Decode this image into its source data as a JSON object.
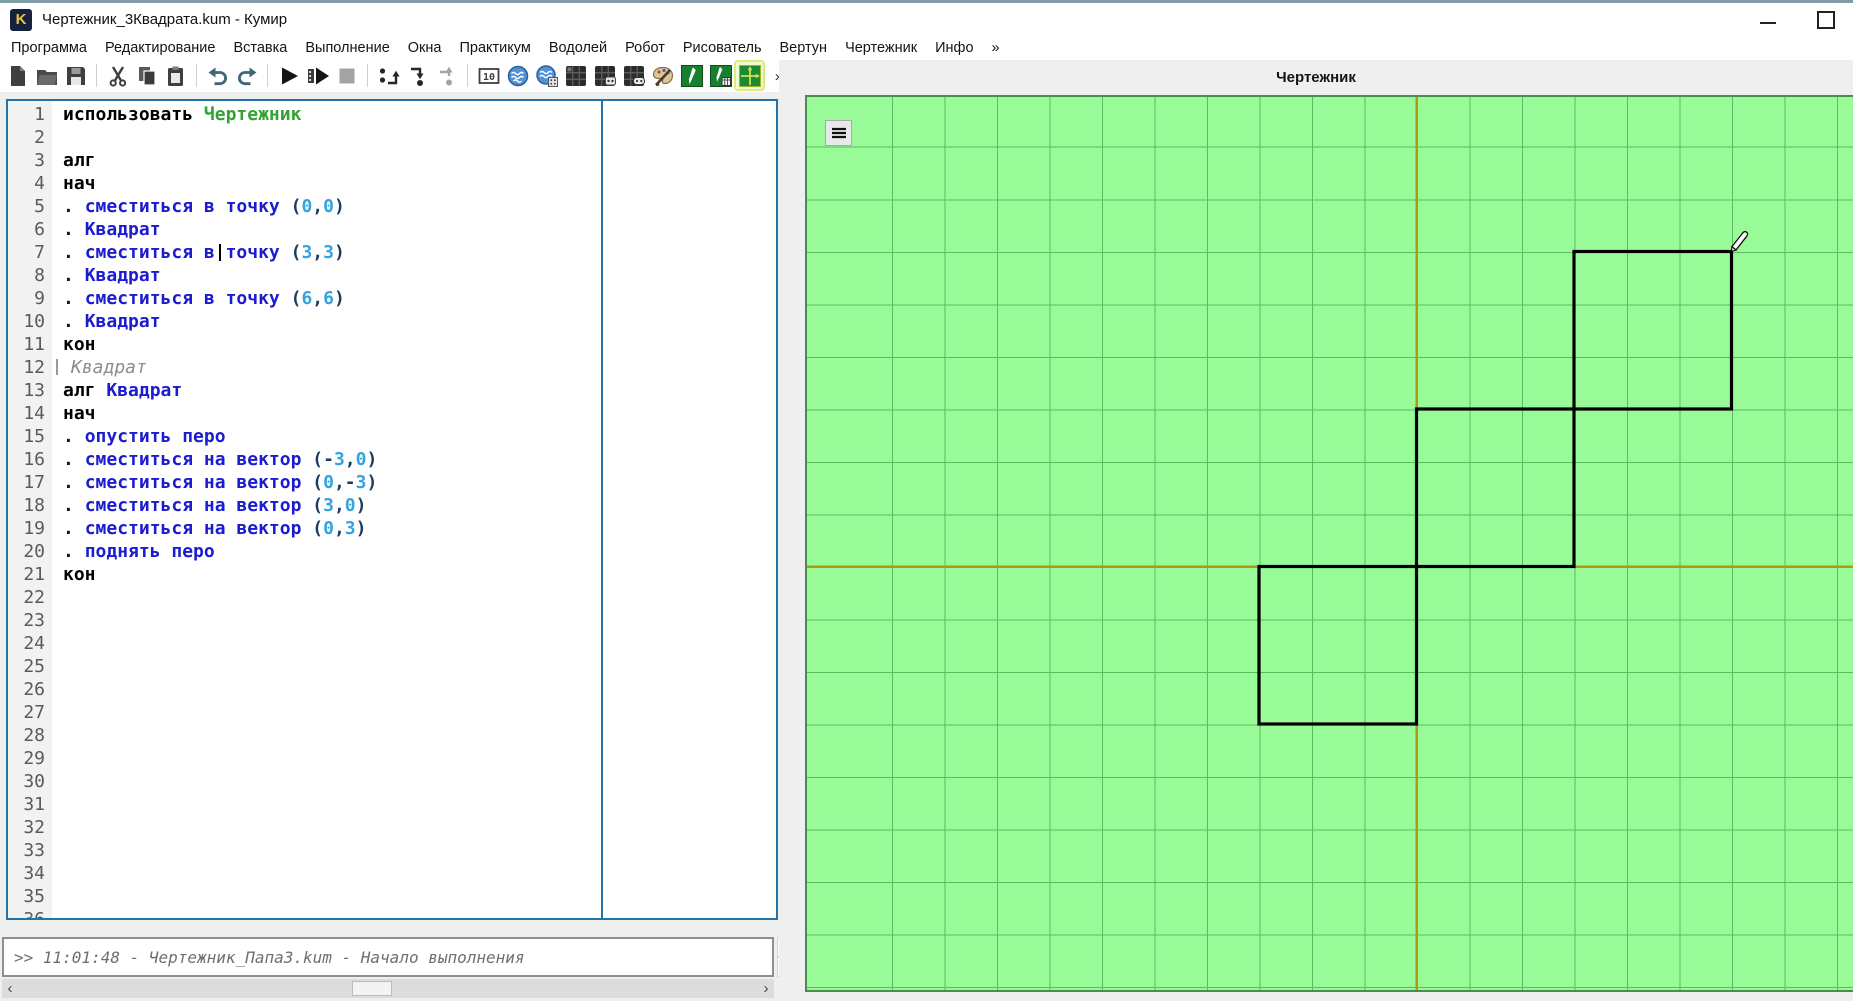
{
  "window": {
    "title": "Чертежник_3Квадрата.kum - Кумир",
    "logo_letter": "K",
    "controls": {
      "minimize": "minimize",
      "maximize": "maximize"
    }
  },
  "menu": {
    "items": [
      "Программа",
      "Редактирование",
      "Вставка",
      "Выполнение",
      "Окна",
      "Практикум",
      "Водолей",
      "Робот",
      "Рисователь",
      "Вертун",
      "Чертежник",
      "Инфо",
      "»"
    ]
  },
  "toolbar": {
    "items": [
      {
        "icon": "new-file"
      },
      {
        "icon": "open-file"
      },
      {
        "icon": "save-file",
        "sep_after": true
      },
      {
        "icon": "cut"
      },
      {
        "icon": "copy"
      },
      {
        "icon": "paste",
        "sep_after": true
      },
      {
        "icon": "undo"
      },
      {
        "icon": "redo",
        "sep_after": true
      },
      {
        "icon": "run"
      },
      {
        "icon": "run-detailed"
      },
      {
        "icon": "stop",
        "disabled": true,
        "sep_after": true
      },
      {
        "icon": "step-over"
      },
      {
        "icon": "step-into"
      },
      {
        "icon": "step-out",
        "disabled": true,
        "sep_after": true
      },
      {
        "icon": "io-window"
      },
      {
        "icon": "vodoley"
      },
      {
        "icon": "vodoley-pult"
      },
      {
        "icon": "robot"
      },
      {
        "icon": "robot-pult"
      },
      {
        "icon": "vertun"
      },
      {
        "icon": "risovatel"
      },
      {
        "icon": "chertezhnik"
      },
      {
        "icon": "chertezhnik-pult"
      },
      {
        "icon": "chertezhnik-window",
        "active": true
      },
      {
        "icon": "overflow-chevron"
      }
    ],
    "io_icon_text": "10",
    "overflow_label": "»"
  },
  "editor": {
    "visible_line_numbers": 36,
    "cursor_line": 7,
    "lines": [
      {
        "n": 1,
        "t": [
          [
            "использовать ",
            "k"
          ],
          [
            "Чертежник",
            "a"
          ]
        ]
      },
      {
        "n": 2,
        "t": []
      },
      {
        "n": 3,
        "t": [
          [
            "алг",
            "k"
          ]
        ]
      },
      {
        "n": 4,
        "t": [
          [
            "нач",
            "k"
          ]
        ]
      },
      {
        "n": 5,
        "t": [
          [
            ". ",
            "d"
          ],
          [
            "сместиться в точку ",
            "c"
          ],
          [
            "(",
            "p"
          ],
          [
            "0",
            "n"
          ],
          [
            ",",
            "p"
          ],
          [
            "0",
            "n"
          ],
          [
            ")",
            "p"
          ]
        ]
      },
      {
        "n": 6,
        "t": [
          [
            ". ",
            "d"
          ],
          [
            "Квадрат",
            "c"
          ]
        ]
      },
      {
        "n": 7,
        "t": [
          [
            ". ",
            "d"
          ],
          [
            "сместиться в точку ",
            "c"
          ],
          [
            "(",
            "p"
          ],
          [
            "3",
            "n"
          ],
          [
            ",",
            "p"
          ],
          [
            "3",
            "n"
          ],
          [
            ")",
            "p"
          ]
        ],
        "cursor": true
      },
      {
        "n": 8,
        "t": [
          [
            ". ",
            "d"
          ],
          [
            "Квадрат",
            "c"
          ]
        ]
      },
      {
        "n": 9,
        "t": [
          [
            ". ",
            "d"
          ],
          [
            "сместиться в точку ",
            "c"
          ],
          [
            "(",
            "p"
          ],
          [
            "6",
            "n"
          ],
          [
            ",",
            "p"
          ],
          [
            "6",
            "n"
          ],
          [
            ")",
            "p"
          ]
        ]
      },
      {
        "n": 10,
        "t": [
          [
            ". ",
            "d"
          ],
          [
            "Квадрат",
            "c"
          ]
        ]
      },
      {
        "n": 11,
        "t": [
          [
            "кон",
            "k"
          ]
        ]
      },
      {
        "n": 12,
        "ghost": "Квадрат"
      },
      {
        "n": 13,
        "t": [
          [
            "алг ",
            "k"
          ],
          [
            "Квадрат",
            "c"
          ]
        ]
      },
      {
        "n": 14,
        "t": [
          [
            "нач",
            "k"
          ]
        ]
      },
      {
        "n": 15,
        "t": [
          [
            ". ",
            "d"
          ],
          [
            "опустить перо",
            "c"
          ]
        ]
      },
      {
        "n": 16,
        "t": [
          [
            ". ",
            "d"
          ],
          [
            "сместиться на вектор ",
            "c"
          ],
          [
            "(",
            "p"
          ],
          [
            "-",
            "p"
          ],
          [
            "3",
            "n"
          ],
          [
            ",",
            "p"
          ],
          [
            "0",
            "n"
          ],
          [
            ")",
            "p"
          ]
        ]
      },
      {
        "n": 17,
        "t": [
          [
            ". ",
            "d"
          ],
          [
            "сместиться на вектор ",
            "c"
          ],
          [
            "(",
            "p"
          ],
          [
            "0",
            "n"
          ],
          [
            ",",
            "p"
          ],
          [
            "-",
            "p"
          ],
          [
            "3",
            "n"
          ],
          [
            ")",
            "p"
          ]
        ]
      },
      {
        "n": 18,
        "t": [
          [
            ". ",
            "d"
          ],
          [
            "сместиться на вектор ",
            "c"
          ],
          [
            "(",
            "p"
          ],
          [
            "3",
            "n"
          ],
          [
            ",",
            "p"
          ],
          [
            "0",
            "n"
          ],
          [
            ")",
            "p"
          ]
        ]
      },
      {
        "n": 19,
        "t": [
          [
            ". ",
            "d"
          ],
          [
            "сместиться на вектор ",
            "c"
          ],
          [
            "(",
            "p"
          ],
          [
            "0",
            "n"
          ],
          [
            ",",
            "p"
          ],
          [
            "3",
            "n"
          ],
          [
            ")",
            "p"
          ]
        ]
      },
      {
        "n": 20,
        "t": [
          [
            ". ",
            "d"
          ],
          [
            "поднять перо",
            "c"
          ]
        ]
      },
      {
        "n": 21,
        "t": [
          [
            "кон",
            "k"
          ]
        ]
      }
    ]
  },
  "console": {
    "text": ">> 11:01:48 - Чертежник_Папа3.kum - Начало выполнения"
  },
  "drawer": {
    "title": "Чертежник",
    "squares_units": [
      {
        "x0": -3,
        "y0": -3,
        "x1": 0,
        "y1": 0
      },
      {
        "x0": 0,
        "y0": 0,
        "x1": 3,
        "y1": 3
      },
      {
        "x0": 3,
        "y0": 3,
        "x1": 6,
        "y1": 6
      }
    ],
    "pen_position_units": [
      6,
      6
    ],
    "colors": {
      "background": "#98fb98",
      "grid": "#57bd5f",
      "axis": "#ab9a10",
      "figure": "#000000"
    }
  }
}
